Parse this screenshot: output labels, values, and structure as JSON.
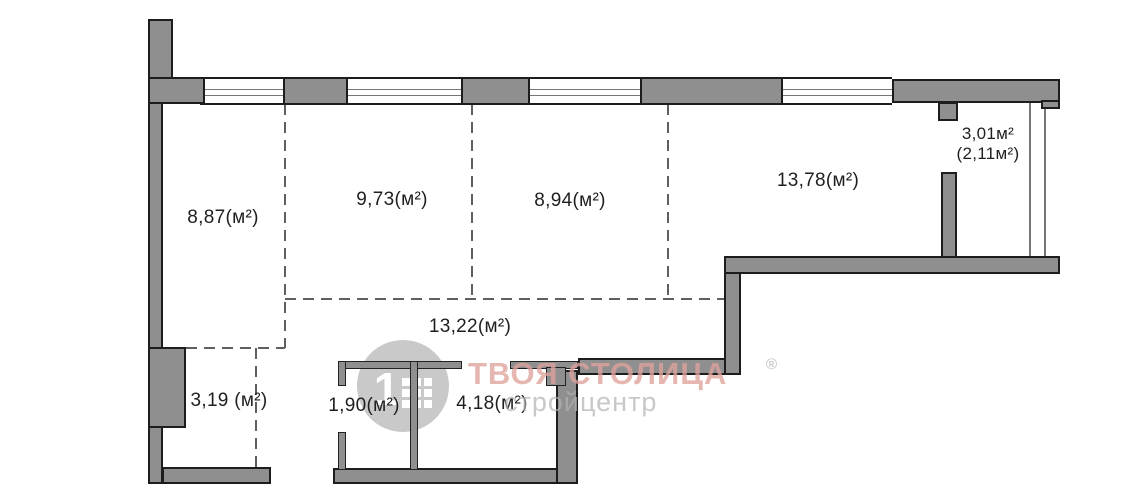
{
  "plan": {
    "rooms": [
      {
        "name": "room-8-87",
        "label": "8,87(м²)"
      },
      {
        "name": "room-9-73",
        "label": "9,73(м²)"
      },
      {
        "name": "room-8-94",
        "label": "8,94(м²)"
      },
      {
        "name": "room-13-78",
        "label": "13,78(м²)"
      },
      {
        "name": "corridor-13-22",
        "label": "13,22(м²)"
      },
      {
        "name": "room-3-19",
        "label": "3,19 (м²)"
      },
      {
        "name": "room-1-90",
        "label": "1,90(м²)"
      },
      {
        "name": "room-4-18",
        "label": "4,18(м²)"
      }
    ],
    "balcony": {
      "area_label": "3,01м²",
      "reduced_area_label": "(2,11м²)"
    }
  },
  "watermark": {
    "logo_digit": "1",
    "brand_text": "ТВОЯ СТОЛИЦА",
    "registered_symbol": "®",
    "subtitle_text": "стройцентр"
  },
  "colors": {
    "wall_fill": "#8f8f8f",
    "wall_outline": "#1d1d1d",
    "partition_outline": "#222222",
    "dash_color": "#5f5f5f",
    "label_color": "#1f1f1f",
    "glazing_color": "#777777",
    "brand_pink": "#dfa29c",
    "watermark_gray": "#b2b2b2",
    "logo_gray": "#9e9e9e"
  }
}
